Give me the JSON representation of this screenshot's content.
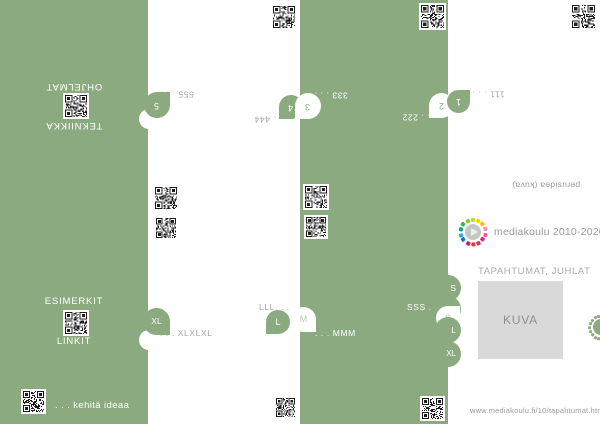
{
  "colors": {
    "accent_green": "#8baa7f",
    "muted_gray_text": "#a5a5a5",
    "placeholder_gray": "#d9d9d9"
  },
  "icons": {
    "qr_code": "pixel-grid",
    "logo_play": "play-triangle",
    "edge_stamp": "half-ring-of-squares"
  },
  "back": {
    "left_title_a": "OHJELMAT",
    "left_title_b": "TEKNIIKKA",
    "tab5": "5",
    "note5": "555 . . .",
    "tab4": "4",
    "note4": ". . . 444",
    "tab3": "3",
    "note3": "333 . . .",
    "tab2": "2",
    "note2": ". . . 222",
    "tab1": "1",
    "note1": "111 . . .",
    "caption": "perusidea (kuva)"
  },
  "front": {
    "left_title_a": "ESIMERKIT",
    "left_title_b": "LINKIT",
    "tab_xl": "XL",
    "note_xl": ". . . XLXLXL",
    "tab_l": "L",
    "note_l": "LLL. . .",
    "tab_m": "M",
    "note_m": ". . . MMM",
    "stack": {
      "s": "S",
      "m": "M",
      "l": "L",
      "xl": "XL",
      "bubble": "S",
      "note": "SSS . . ."
    },
    "footer": ". . . kehitä ideaa",
    "logo": {
      "text": "mediakoulu 2010-2020",
      "ring_colors": [
        "#c6d72f",
        "#ffd400",
        "#fdba12",
        "#f491bd",
        "#ef5ba1",
        "#e81e78",
        "#e0336d",
        "#e23a3a",
        "#c21f6d",
        "#1b75bb",
        "#2aa9e0",
        "#00a79d",
        "#39b54a",
        "#8cc63f"
      ]
    },
    "section_title": "TAPAHTUMAT, JUHLAT",
    "image_placeholder": "KUVA",
    "url": "www.mediakoulu.fi/10/tapahtumat.html"
  }
}
